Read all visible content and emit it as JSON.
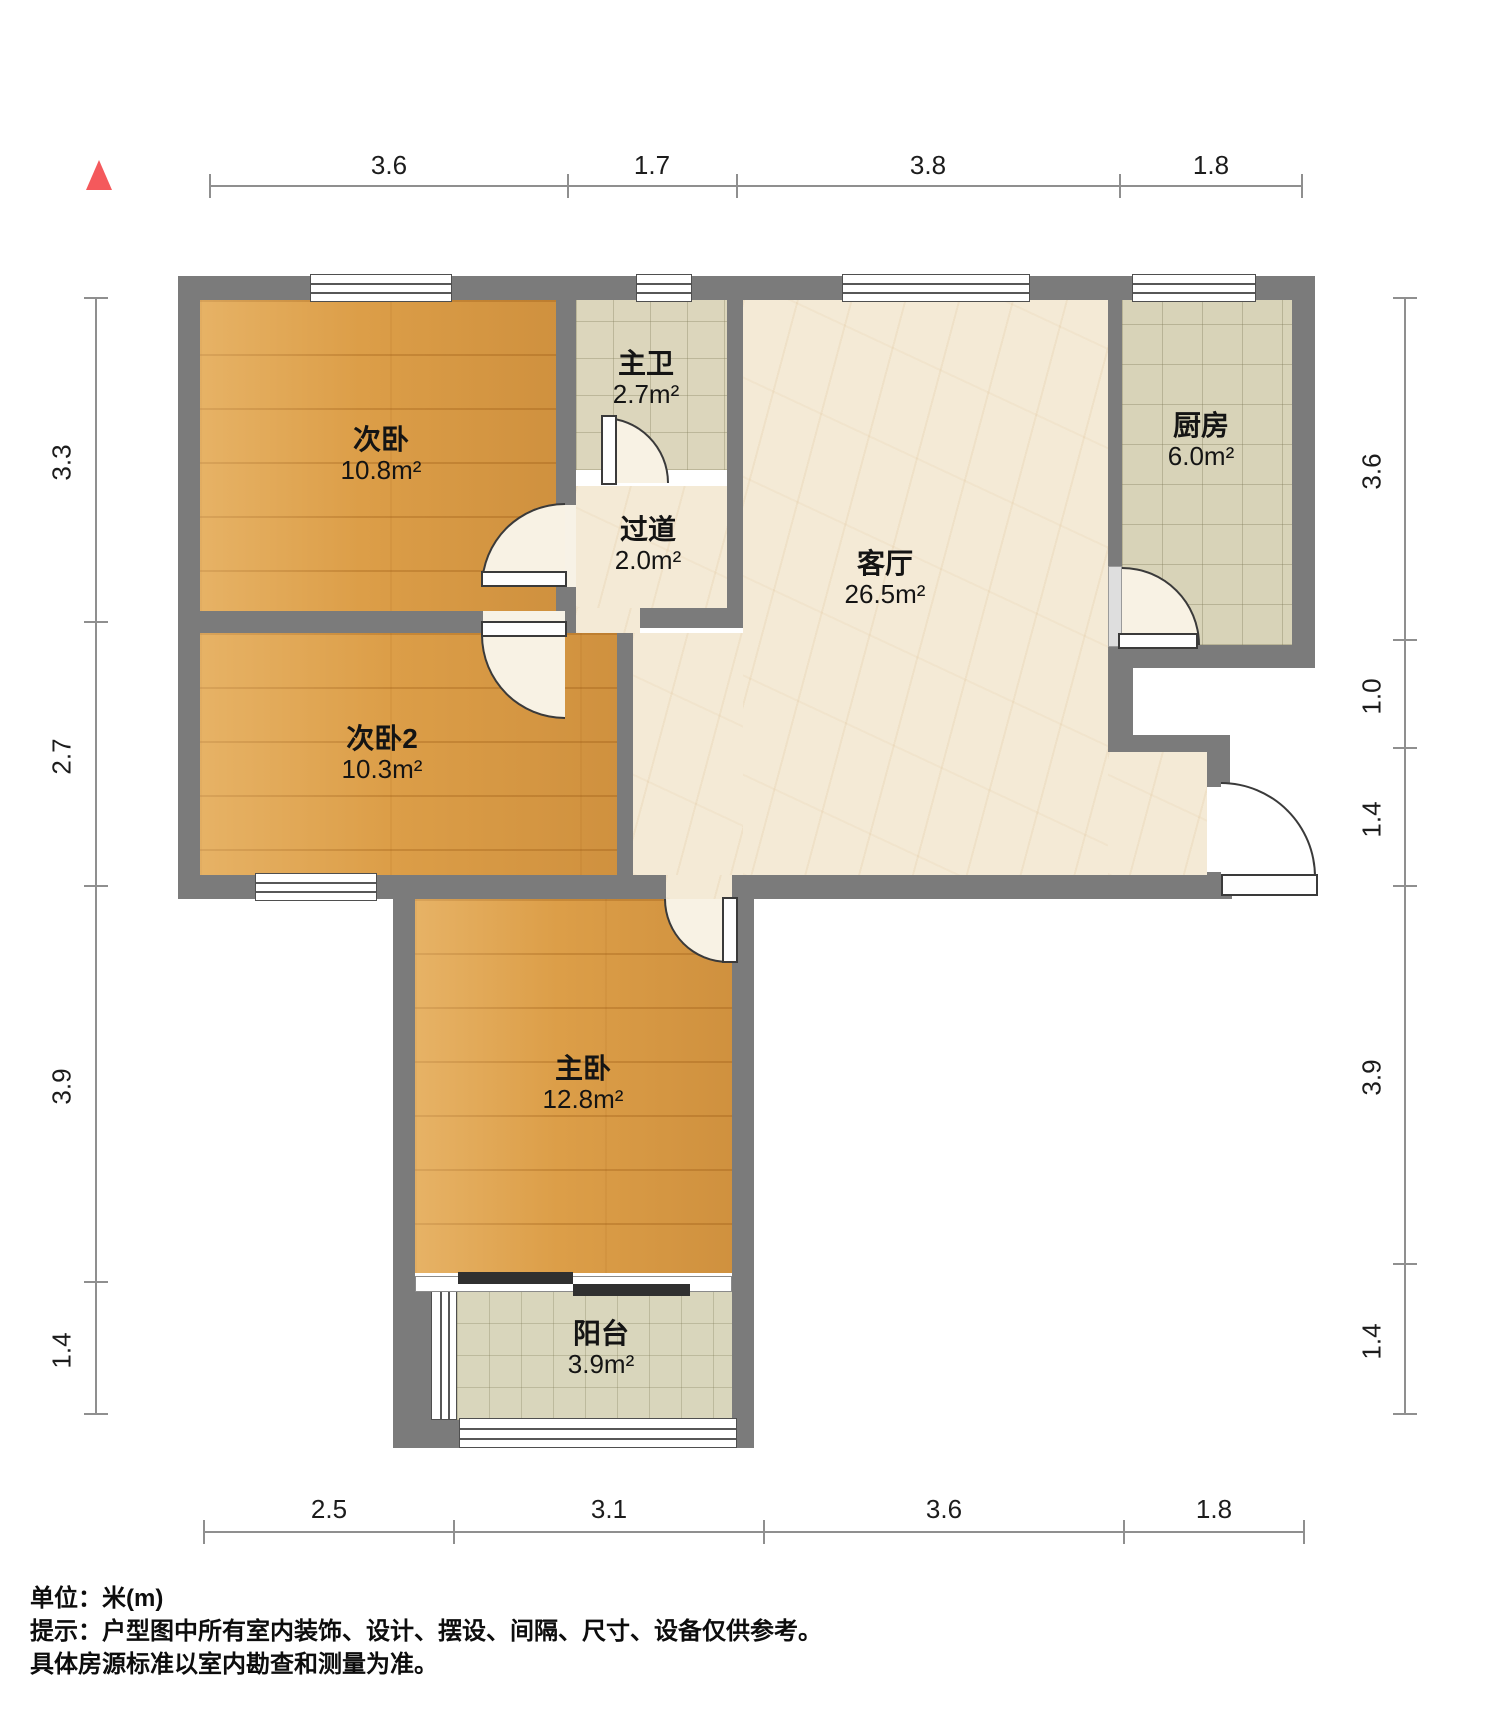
{
  "plan": {
    "type": "apartment-floorplan",
    "rooms": [
      {
        "name": "次卧",
        "area": "10.8m²"
      },
      {
        "name": "主卫",
        "area": "2.7m²"
      },
      {
        "name": "过道",
        "area": "2.0m²"
      },
      {
        "name": "客厅",
        "area": "26.5m²"
      },
      {
        "name": "厨房",
        "area": "6.0m²"
      },
      {
        "name": "次卧2",
        "area": "10.3m²"
      },
      {
        "name": "主卧",
        "area": "12.8m²"
      },
      {
        "name": "阳台",
        "area": "3.9m²"
      }
    ],
    "colors": {
      "wall": "#7b7b7b",
      "wood_floor": "#dc9e48",
      "marble_floor": "#f4ead6",
      "tile_floor": "#d8d3b8",
      "north_arrow": "#f4595c",
      "dimension_line": "#8f8f8f"
    }
  },
  "dimensions": {
    "top": [
      "3.6",
      "1.7",
      "3.8",
      "1.8"
    ],
    "left": [
      "3.3",
      "2.7",
      "3.9",
      "1.4"
    ],
    "right": [
      "3.6",
      "1.0",
      "1.4",
      "3.9",
      "1.4"
    ],
    "bottom": [
      "2.5",
      "3.1",
      "3.6",
      "1.8"
    ]
  },
  "notes": {
    "unit": "单位：米(m)",
    "tip_line1": "提示：户型图中所有室内装饰、设计、摆设、间隔、尺寸、设备仅供参考。",
    "tip_line2": "具体房源标准以室内勘查和测量为准。"
  }
}
